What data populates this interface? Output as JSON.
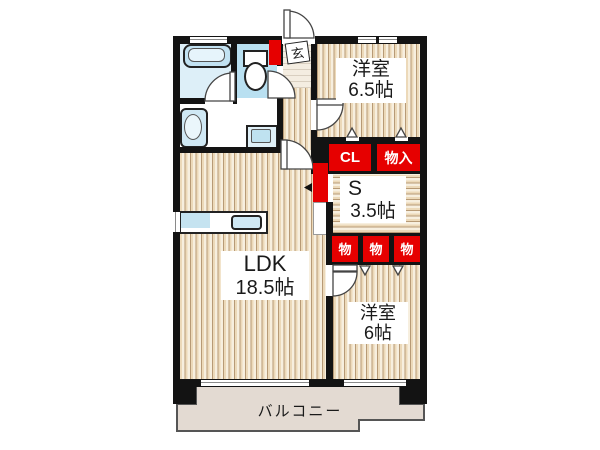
{
  "floorplan": {
    "rooms": {
      "ldk": {
        "name": "LDK",
        "size": "18.5帖"
      },
      "bedroom1": {
        "name": "洋室",
        "size": "6.5帖"
      },
      "service_room": {
        "name": "S",
        "size": "3.5帖"
      },
      "bedroom2": {
        "name": "洋室",
        "size": "6帖"
      },
      "balcony": {
        "name": "バルコニー"
      },
      "entrance": {
        "name": "玄"
      }
    },
    "storage": {
      "closet": "CL",
      "monoire": "物入",
      "mono_1": "物",
      "mono_2": "物",
      "mono_3": "物"
    },
    "colors": {
      "storage_red": "#e60000",
      "wall_black": "#131313",
      "wood_floor": "#ecd9b9",
      "water_blue": "#bfe4f2",
      "balcony_beige": "#e3dad2"
    }
  }
}
